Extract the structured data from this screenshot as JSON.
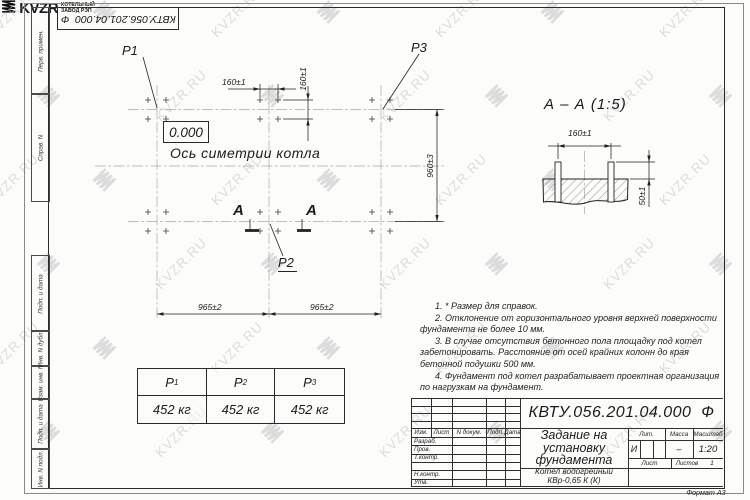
{
  "watermark": {
    "text": "KVZR.RU"
  },
  "top_stamp": {
    "designation": "КВТУ.056.201.04.000  Ф"
  },
  "side_labels": [
    "Перв. примен.",
    "Справ. N",
    "Подп. и дата",
    "Инв. N дубл.",
    "Взам. инв. N",
    "Подп. и дата",
    "Инв. N подл."
  ],
  "plan": {
    "p1_label": "P1",
    "p2_label": "P2",
    "p3_label": "P3",
    "elevation": "0.000",
    "axis_label": "Ось симетрии котла",
    "dim_160_h": "160±1",
    "dim_160_v": "160±1",
    "dim_960": "960±3",
    "dim_965_left": "965±2",
    "dim_965_right": "965±2",
    "section_letter": "А"
  },
  "section": {
    "title": "А – А (1:5)",
    "dim_160": "160±1",
    "dim_50": "50±1"
  },
  "notes": [
    "1. * Размер для справок.",
    "2. Отклонение от горизонтального уровня верхней поверхности фундамента не более 10 мм.",
    "3. В случае отсутствия бетонного пола площадку под котел забетонировать. Расстояние от осей крайних колонн до края бетонной подушки 500 мм.",
    "4. Фундамент под котел разрабатывает проектная организация по нагрузкам на фундамент."
  ],
  "load_table": {
    "columns": [
      {
        "sym": "P",
        "sub": "1",
        "value": "452 кг"
      },
      {
        "sym": "P",
        "sub": "2",
        "value": "452 кг"
      },
      {
        "sym": "P",
        "sub": "3",
        "value": "452 кг"
      }
    ]
  },
  "title_block": {
    "designation": "КВТУ.056.201.04.000  Ф",
    "title_lines": [
      "Задание на",
      "установку",
      "фундамента"
    ],
    "product_lines": [
      "Котел водогрейный",
      "КВр-0,65 К (К)"
    ],
    "header_cols": [
      "Изм.",
      "Лист",
      "N докум.",
      "Подп.",
      "Дата"
    ],
    "rows": [
      "Разраб.",
      "Пров.",
      "Т.контр.",
      "",
      "Н.контр.",
      "Утв."
    ],
    "lit_label": "Лит.",
    "lit_value": "И",
    "mass_label": "Масса",
    "mass_value": "–",
    "scale_label": "Масштаб",
    "scale_value": "1:20",
    "sheet_label": "Лист",
    "sheets_label": "Листов",
    "sheets_value": "1",
    "logo_text": "KVZR",
    "company_lines": [
      "КОТЕЛЬНЫЙ",
      "ЗАВОД РЭП"
    ],
    "format_label": "Формат А3"
  }
}
